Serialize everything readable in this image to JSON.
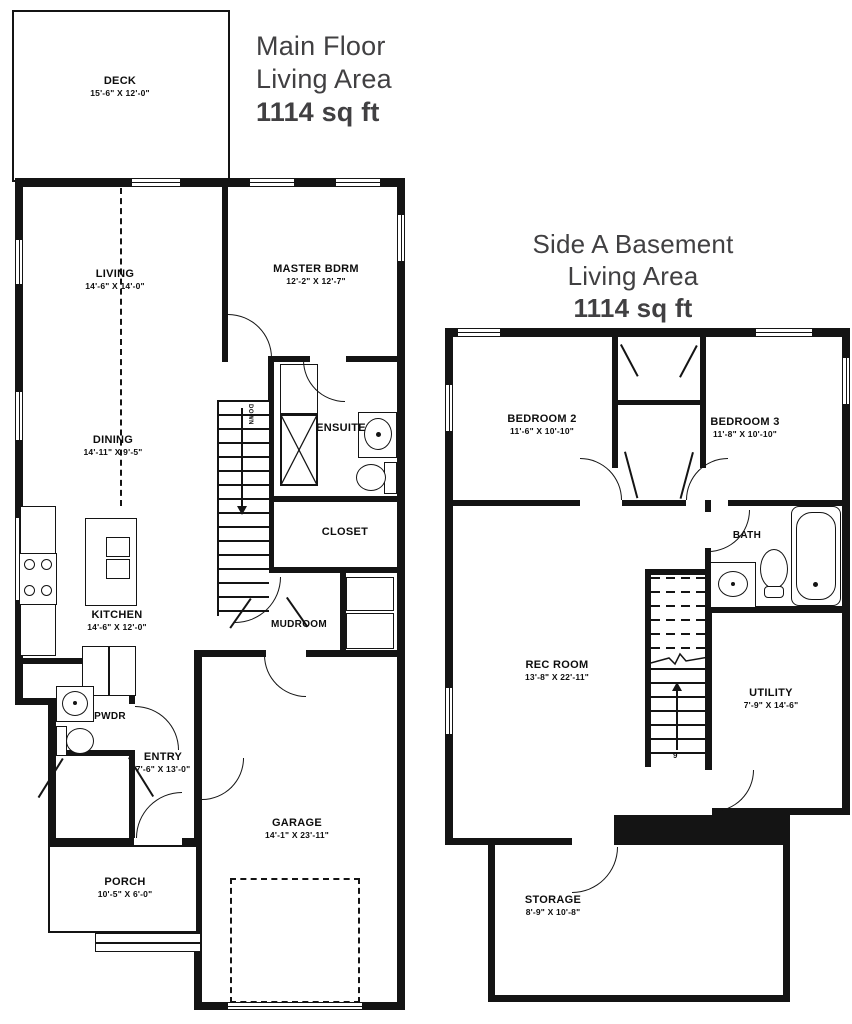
{
  "colors": {
    "wall": "#141414",
    "title_text": "#414042",
    "label_text": "#0d0d0d"
  },
  "main_floor": {
    "title": {
      "line1": "Main Floor",
      "line2": "Living Area",
      "sqft": "1114 sq ft"
    },
    "rooms": {
      "deck": {
        "name": "DECK",
        "dims": "15'-6\" X 12'-0\""
      },
      "living": {
        "name": "LIVING",
        "dims": "14'-6\" X 14'-0\""
      },
      "master": {
        "name": "MASTER BDRM",
        "dims": "12'-2\" X 12'-7\""
      },
      "dining": {
        "name": "DINING",
        "dims": "14'-11\" X 9'-5\""
      },
      "ensuite": {
        "name": "ENSUITE",
        "dims": ""
      },
      "closet": {
        "name": "CLOSET",
        "dims": ""
      },
      "kitchen": {
        "name": "KITCHEN",
        "dims": "14'-6\" X 12'-0\""
      },
      "mudroom": {
        "name": "MUDROOM",
        "dims": ""
      },
      "pwdr": {
        "name": "PWDR",
        "dims": ""
      },
      "entry": {
        "name": "ENTRY",
        "dims": "7'-6\" X 13'-0\""
      },
      "garage": {
        "name": "GARAGE",
        "dims": "14'-1\" X 23'-11\""
      },
      "porch": {
        "name": "PORCH",
        "dims": "10'-5\" X 6'-0\""
      }
    },
    "stairs": {
      "direction_label": "DOWN"
    }
  },
  "basement": {
    "title": {
      "line1": "Side A Basement",
      "line2": "Living Area",
      "sqft": "1114 sq ft"
    },
    "rooms": {
      "bedroom2": {
        "name": "BEDROOM 2",
        "dims": "11'-6\" X 10'-10\""
      },
      "bedroom3": {
        "name": "BEDROOM 3",
        "dims": "11'-8\" X 10'-10\""
      },
      "bath": {
        "name": "BATH",
        "dims": ""
      },
      "rec_room": {
        "name": "REC ROOM",
        "dims": "13'-8\" X 22'-11\""
      },
      "utility": {
        "name": "UTILITY",
        "dims": "7'-9\" X 14'-6\""
      },
      "storage": {
        "name": "STORAGE",
        "dims": "8'-9\" X 10'-8\""
      }
    },
    "stairs": {
      "riser_count": "9"
    }
  }
}
